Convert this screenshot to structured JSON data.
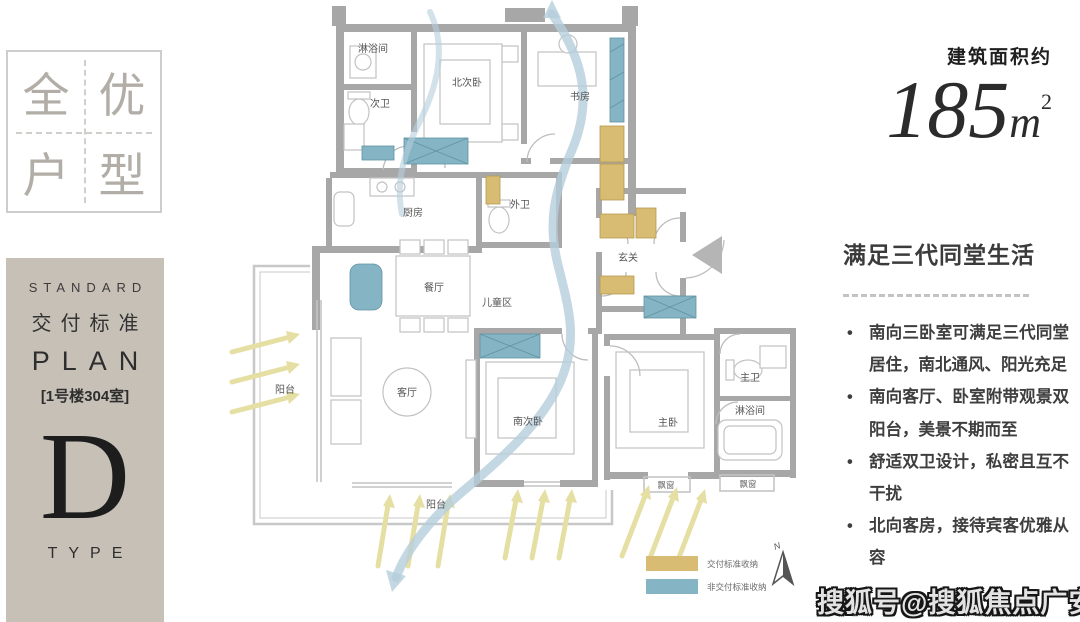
{
  "logo": {
    "chars": [
      "全",
      "优",
      "户",
      "型"
    ]
  },
  "sidebar": {
    "standard_label": "STANDARD",
    "title_cn": "交付标准",
    "plan_label": "PLAN",
    "unit_label": "[1号楼304室]",
    "type_letter": "D",
    "type_label": "TYPE"
  },
  "area": {
    "prefix": "建筑面积约",
    "value": "185",
    "unit": "m",
    "sup": "2"
  },
  "highlights": {
    "heading": "满足三代同堂生活",
    "bullets": [
      "南向三卧室可满足三代同堂居住，南北通风、阳光充足",
      "南向客厅、卧室附带观景双阳台，美景不期而至",
      "舒适双卫设计，私密且互不干扰",
      "北向客房，接待宾客优雅从容"
    ]
  },
  "floorplan": {
    "rooms": {
      "shower_n": "淋浴间",
      "bath_second": "次卫",
      "bed_north": "北次卧",
      "study": "书房",
      "kitchen": "厨房",
      "bath_outer": "外卫",
      "foyer": "玄关",
      "dining": "餐厅",
      "kids_zone": "儿童区",
      "living": "客厅",
      "balcony_west": "阳台",
      "balcony_south": "阳台",
      "bed_south": "南次卧",
      "bed_master": "主卧",
      "bath_master": "主卫",
      "shower_s": "淋浴间",
      "bay_window_1": "飘窗",
      "bay_window_2": "飘窗"
    },
    "legend": {
      "item1": {
        "label": "交付标准收纳",
        "color": "#d8bc74"
      },
      "item2": {
        "label": "非交付标准收纳",
        "color": "#85b5c4"
      }
    },
    "north_label": "N"
  },
  "watermark": "搜狐号@搜狐焦点广安站",
  "colors": {
    "sidebar_bg": "#c6c0b7",
    "wall": "#a7a7a7",
    "storage_delivered": "#d8bc74",
    "storage_not_delivered": "#85b5c4",
    "sun_arrow": "#e6dfa3",
    "wind_arrow": "#b5cedc"
  }
}
